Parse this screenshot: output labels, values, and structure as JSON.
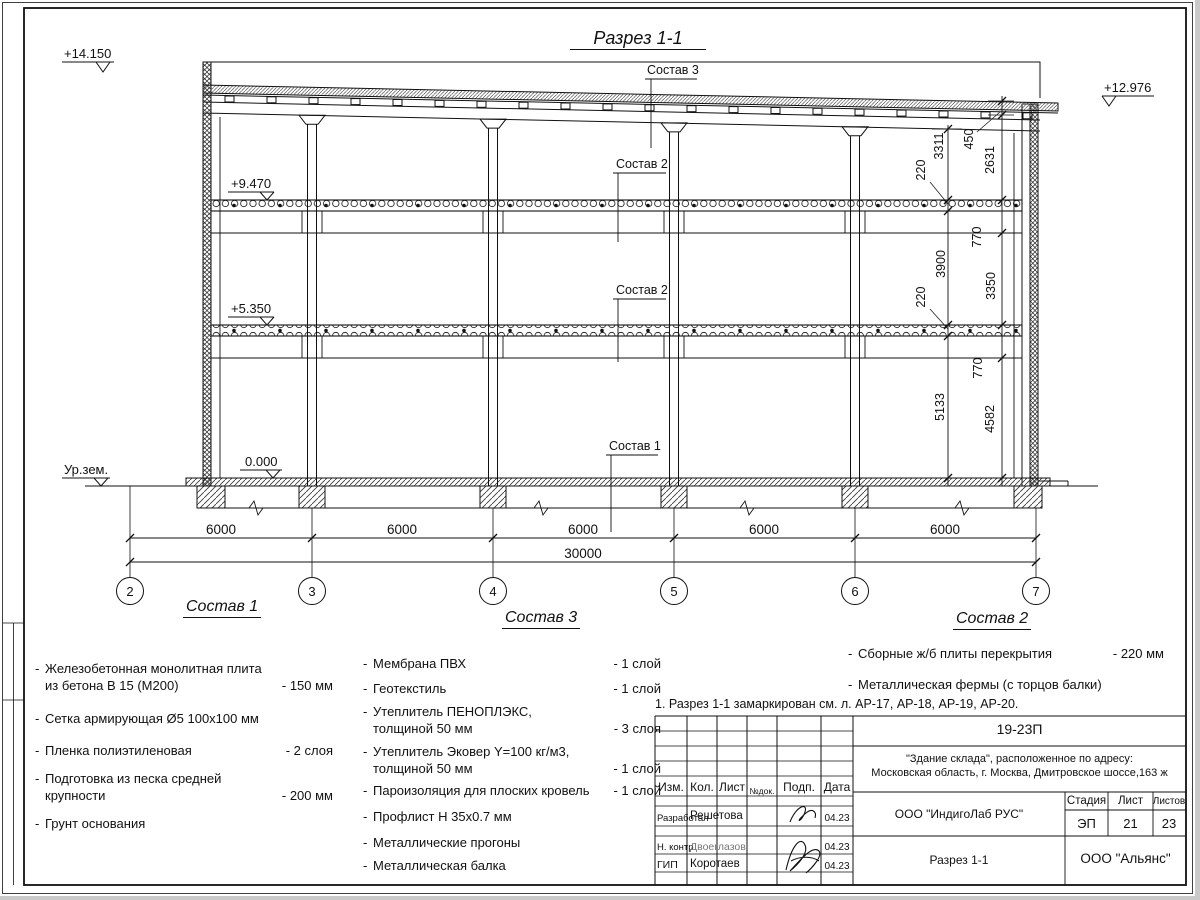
{
  "sheet": {
    "list_marker": "-"
  },
  "title": "Разрез 1-1",
  "levels": {
    "roof_left": "+14.150",
    "roof_right": "+12.976",
    "floor2": "+9.470",
    "floor1": "+5.350",
    "zero": "0.000",
    "ground": "Ур.зем."
  },
  "layer_labels": {
    "roof": "Состав 3",
    "mid": "Состав 2",
    "low": "Состав 2",
    "base": "Состав 1"
  },
  "dims": {
    "right_inner": [
      "3311",
      "220",
      "3900",
      "220",
      "5133"
    ],
    "right_outer": [
      "450",
      "2631",
      "770",
      "3350",
      "770",
      "4582"
    ],
    "bottom_spans": [
      "6000",
      "6000",
      "6000",
      "6000",
      "6000"
    ],
    "bottom_total": "30000"
  },
  "axes": [
    "2",
    "3",
    "4",
    "5",
    "6",
    "7"
  ],
  "compositions": [
    {
      "heading": "Состав 1",
      "items": [
        {
          "name": "Железобетонная  монолитная плита\nиз бетона В 15 (М200)",
          "value": "- 150 мм"
        },
        {
          "name": "Сетка армирующая Ø5 100х100 мм",
          "value": ""
        },
        {
          "name": "Пленка полиэтиленовая",
          "value": "-  2 слоя"
        },
        {
          "name": "Подготовка из песка средней\nкрупности",
          "value": "- 200 мм"
        },
        {
          "name": "Грунт основания",
          "value": ""
        }
      ]
    },
    {
      "heading": "Состав 3",
      "items": [
        {
          "name": "Мембрана ПВХ",
          "value": "- 1 слой"
        },
        {
          "name": "Геотекстиль",
          "value": "- 1 слой"
        },
        {
          "name": "Утеплитель ПЕНОПЛЭКС,\nтолщиной 50 мм",
          "value": "- 3 слоя"
        },
        {
          "name": "Утеплитель Эковер Y=100 кг/м3,\nтолщиной 50 мм",
          "value": "- 1 слой"
        },
        {
          "name": "Пароизоляция для плоских кровель",
          "value": "- 1 слой"
        },
        {
          "name": "Профлист Н 35х0.7 мм",
          "value": ""
        },
        {
          "name": "Металлические прогоны",
          "value": ""
        },
        {
          "name": "Металлическая балка",
          "value": ""
        }
      ]
    },
    {
      "heading": "Состав 2",
      "items": [
        {
          "name": "Сборные ж/б плиты перекрытия",
          "value": "- 220 мм"
        },
        {
          "name": "Металлическая фермы (с торцов балки)",
          "value": ""
        }
      ]
    }
  ],
  "note": "1. Разрез 1-1 замаркирован см. л. АР-17, АР-18, АР-19, АР-20.",
  "title_block": {
    "doc_number": "19-23П",
    "object_line1": "\"Здание склада\", расположенное по адресу:",
    "object_line2": "Московская область, г. Москва, Дмитровское шоссе,163 ж",
    "company": "ООО \"ИндигоЛаб РУС\"",
    "labels": {
      "izm": "Изм.",
      "kol": "Кол.",
      "list": "Лист",
      "doc": "№док.",
      "podp": "Подп.",
      "data": "Дата",
      "stage": "Стадия",
      "sheet": "Лист",
      "sheets": "Листов"
    },
    "stage": "ЭП",
    "sheet_no": "21",
    "sheet_total": "23",
    "drawing_name": "Разрез 1-1",
    "org": "ООО \"Альянс\"",
    "rows": [
      {
        "role": "Разработал",
        "name": "Решетова",
        "date": "04.23"
      },
      {
        "role": "Н. контр.",
        "name": "Двоеглазов",
        "date": "04.23"
      },
      {
        "role": "ГИП",
        "name": "Коротаев",
        "date": "04.23"
      }
    ]
  }
}
